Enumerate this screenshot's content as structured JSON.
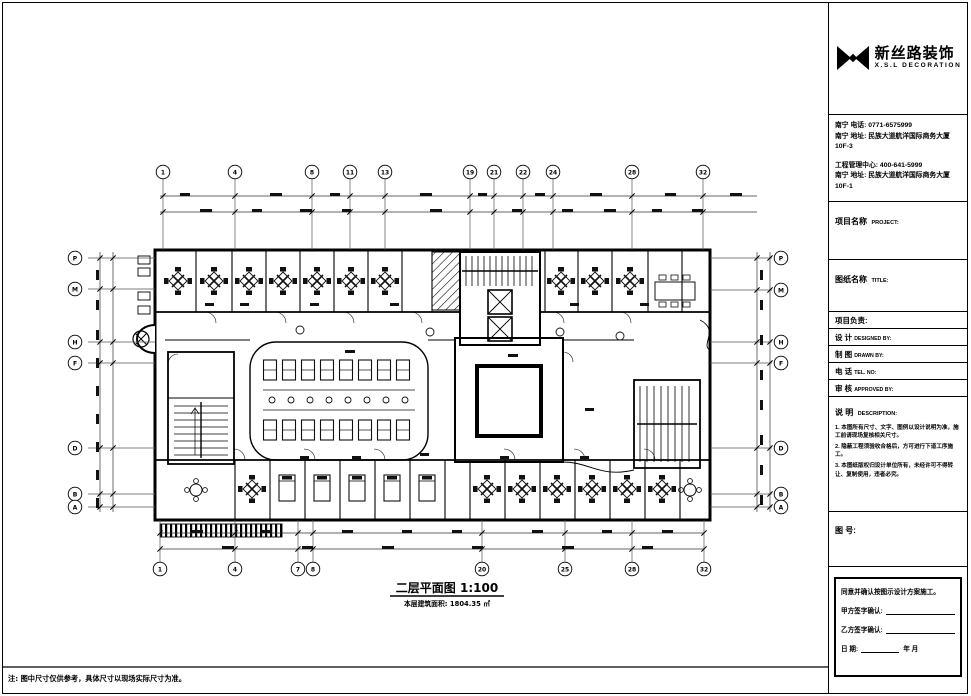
{
  "title_block": {
    "logo": {
      "company_cn": "新丝路装饰",
      "company_en": "X.S.L DECORATION",
      "icon": "xsl-bowtie-logo"
    },
    "contact": {
      "line1": "南宁 电话: 0771-6575999",
      "line2": "南宁 地址: 民族大道航洋国际商务大厦10F-3",
      "line3": "工程管理中心: 400-641-5999",
      "line4": "南宁 地址: 民族大道航洋国际商务大厦10F-1"
    },
    "project_name": {
      "cn": "项目名称",
      "en": "PROJECT:"
    },
    "drawing_name": {
      "cn": "图纸名称",
      "en": "TITLE:"
    },
    "rows": [
      {
        "cn": "项目负责:",
        "en": ""
      },
      {
        "cn": "设  计",
        "en": "DESIGNED BY:"
      },
      {
        "cn": "制  图",
        "en": "DRAWN BY:"
      },
      {
        "cn": "电  话",
        "en": "TEL. NO:"
      },
      {
        "cn": "审  核",
        "en": "APPROVED BY:"
      }
    ],
    "description": {
      "cn": "说  明",
      "en": "DESCRIPTION:"
    },
    "notes": [
      "1. 本图所有尺寸、文字、图例以设计说明为准，施工前请现场复核相关尺寸。",
      "2. 隐蔽工程须验收合格后，方可进行下道工序施工。",
      "3. 本图纸版权归设计单位所有，未经许可不得转让、复制使用，违者必究。"
    ],
    "drawing_no_label": "图  号:",
    "signature": {
      "statement": "同意并确认按图示设计方案施工。",
      "party_a": "甲方签字确认:",
      "party_b": "乙方签字确认:",
      "date_label": "日        期:",
      "date_suffix": "年   月"
    }
  },
  "plan": {
    "caption": "二层平面图 1:100",
    "area_note": "本层建筑面积: 1804.35 ㎡",
    "grid_top": [
      "1",
      "4",
      "8",
      "11",
      "13",
      "19",
      "21",
      "22",
      "24",
      "28",
      "32"
    ],
    "grid_bottom": [
      "1",
      "4",
      "7",
      "8",
      "20",
      "25",
      "28",
      "32"
    ],
    "grid_left": [
      "P",
      "M",
      "H",
      "F",
      "D",
      "B",
      "A"
    ],
    "grid_right": [
      "P",
      "M",
      "H",
      "F",
      "D",
      "B",
      "A"
    ]
  },
  "footer_note": "注: 图中尺寸仅供参考，具体尺寸以现场实际尺寸为准。",
  "colors": {
    "ink": "#000000",
    "paper": "#ffffff",
    "gridline": "#555555"
  }
}
